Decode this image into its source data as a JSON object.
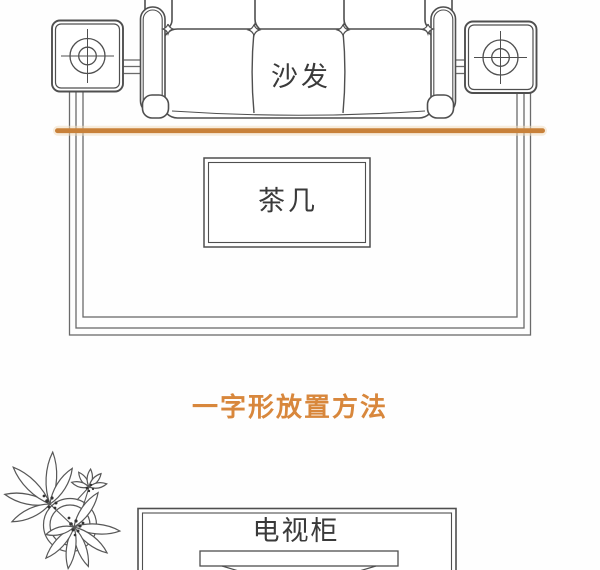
{
  "palette": {
    "accent_orange": "#c8813a",
    "accent_orange_halo": "#f0dcc0",
    "caption_orange": "#d8873c",
    "line_gray": "#4f4f4f",
    "rug_line_gray": "#6a6a6a",
    "text_dark": "#3a3a3a",
    "background": "#fefefe"
  },
  "floor_plan": {
    "sofa": {
      "label": "沙发"
    },
    "coffee_table": {
      "label": "茶几"
    },
    "side_tables": {
      "icon": "lamp-top-view-icon",
      "count": 2
    },
    "rug": {
      "style": "triple-line-border"
    },
    "divider": {
      "style": "horizontal-orange-line"
    }
  },
  "caption": {
    "text": "一字形放置方法"
  },
  "tv_area": {
    "tv_cabinet": {
      "label": "电视柜"
    },
    "tv": {
      "style": "screen-bar-with-stand"
    },
    "plant": {
      "icon": "potted-plant-icon"
    }
  }
}
